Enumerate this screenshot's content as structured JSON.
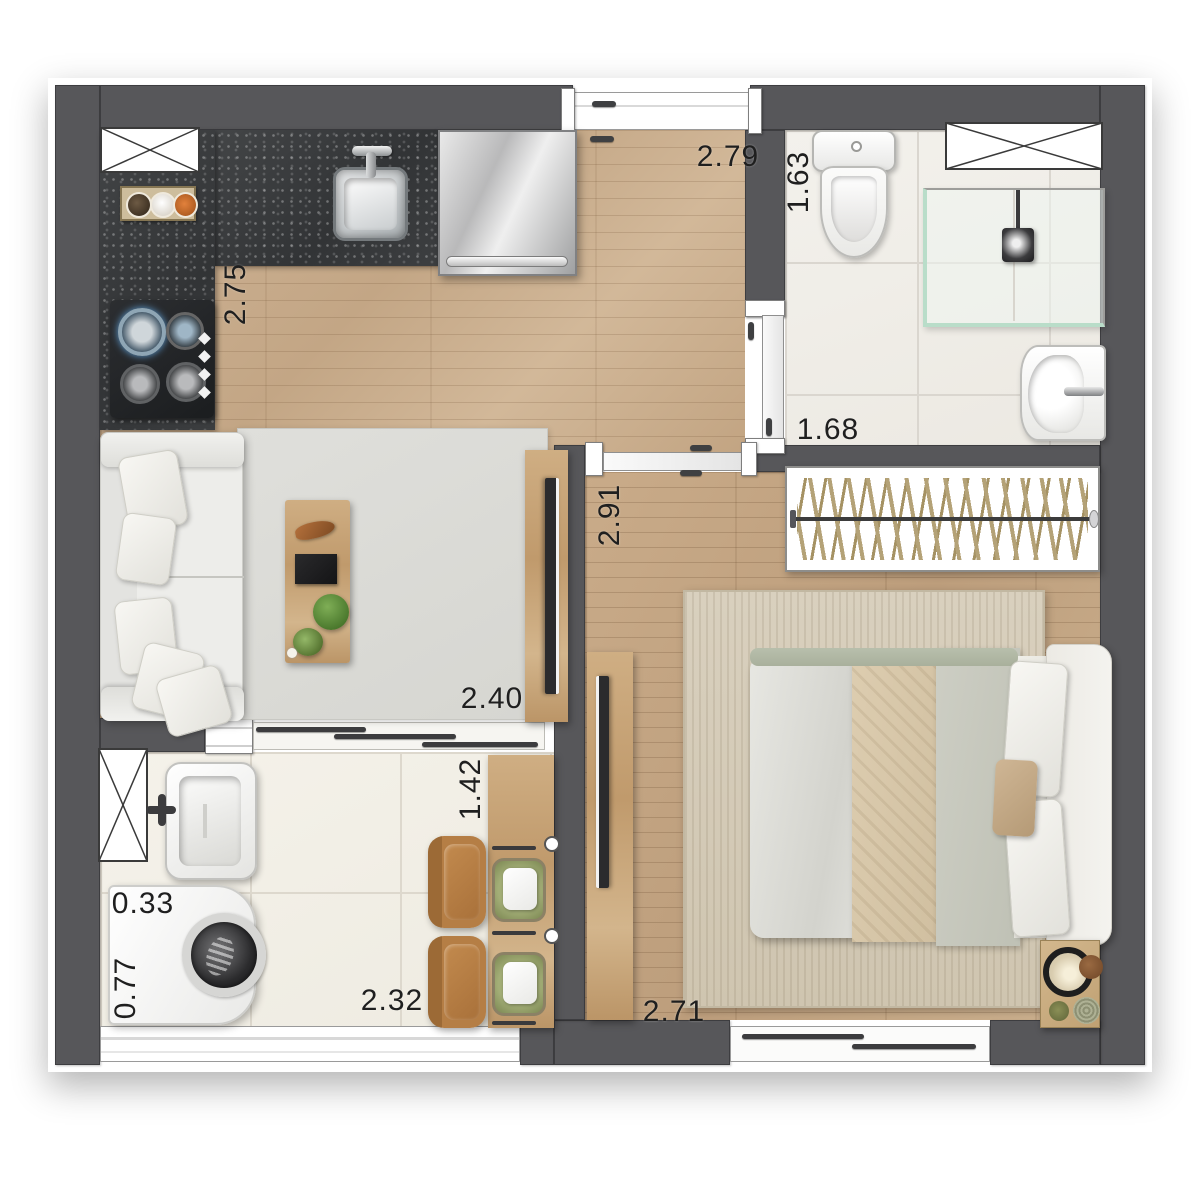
{
  "title": "Studio apartment floor plan (top-view render)",
  "dimensions": {
    "hall_width": "2.79",
    "bath_width": "1.63",
    "bath_length": "1.68",
    "kitchen_depth": "2.75",
    "bedroom_depth": "2.91",
    "living_width": "2.40",
    "balcony_depth": "1.42",
    "service_width": "0.33",
    "service_depth": "0.77",
    "balcony_width": "2.32",
    "bedroom_width": "2.71"
  },
  "colors": {
    "wall": "#57575a",
    "wood_floor": "#c8ad8e",
    "bedroom_floor": "#c3a583",
    "granite_counter": "#3a3c3d",
    "bath_tile": "#f0eee8",
    "balcony_tile": "#f3f0e8",
    "shower_glass_accent": "#bfdecb",
    "sofa": "#ebebe8",
    "living_rug": "#dcdcd8",
    "bedroom_rug": "#d6cdbb",
    "chair": "#b0793f",
    "placemat": "#93a066",
    "table_wood": "#c8a87c",
    "label_text": "#1f1f1f"
  },
  "fixtures": {
    "kitchen": [
      "shaft-window",
      "spice-rack",
      "gas-cooktop",
      "kitchen-sink",
      "refrigerator"
    ],
    "bathroom": [
      "toilet",
      "shower-enclosure",
      "shower-head",
      "wash-basin",
      "sliding-door",
      "shaft-window"
    ],
    "living": [
      "sofa",
      "coffee-table",
      "living-rug",
      "tv-panel"
    ],
    "bedroom": [
      "closet-hangers",
      "double-bed",
      "tv-panel",
      "nightstand-lamp",
      "bedroom-rug",
      "sliding-window"
    ],
    "balcony_service": [
      "utility-sink",
      "washing-machine",
      "dining-table",
      "dining-chairs",
      "shaft-window",
      "sliding-glass-door"
    ]
  }
}
